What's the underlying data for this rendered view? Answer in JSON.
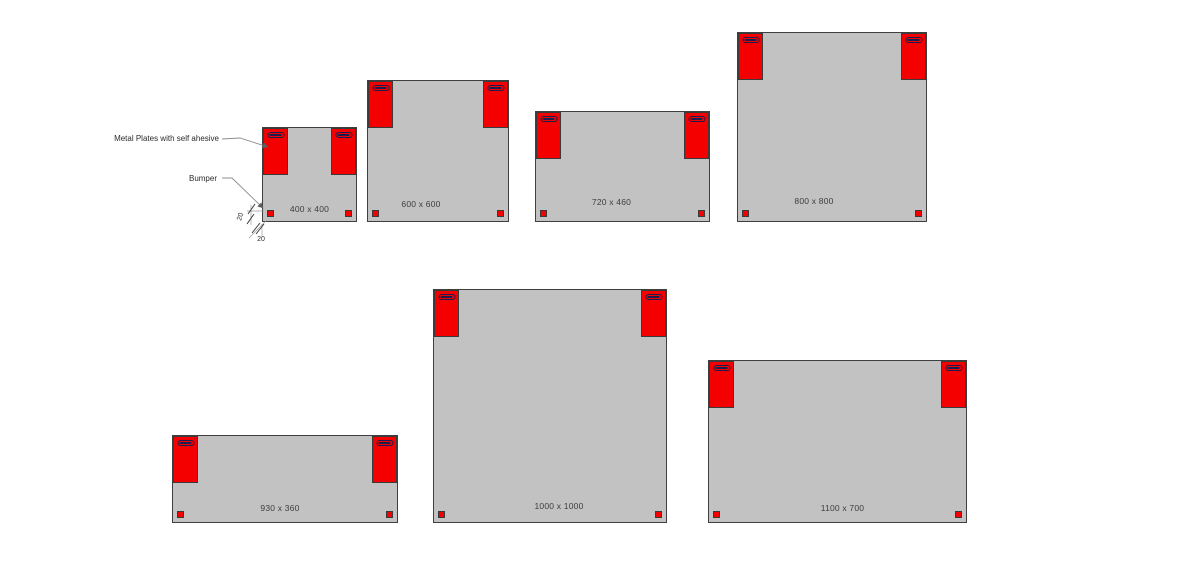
{
  "diagram": {
    "annotations": {
      "metal_plates_label": "Metal Plates with self ahesive",
      "bumper_label": "Bumper",
      "dim_vertical": "20",
      "dim_horizontal": "20"
    },
    "panels": [
      {
        "id": "400x400",
        "label": "400 x 400"
      },
      {
        "id": "600x600",
        "label": "600 x 600"
      },
      {
        "id": "720x460",
        "label": "720 x 460"
      },
      {
        "id": "800x800",
        "label": "800 x 800"
      },
      {
        "id": "930x360",
        "label": "930 x 360"
      },
      {
        "id": "1000x1000",
        "label": "1000 x 1000"
      },
      {
        "id": "1100x700",
        "label": "1100 x 700"
      }
    ],
    "colors": {
      "background": "#FFFFFF",
      "panel_fill": "#C2C2C2",
      "panel_border": "#3F3F3F",
      "plate_red": "#F40000",
      "slot_outline": "#1C1C4E",
      "leader_line": "#8C8C8C",
      "label_text": "#3D3D3D"
    }
  }
}
